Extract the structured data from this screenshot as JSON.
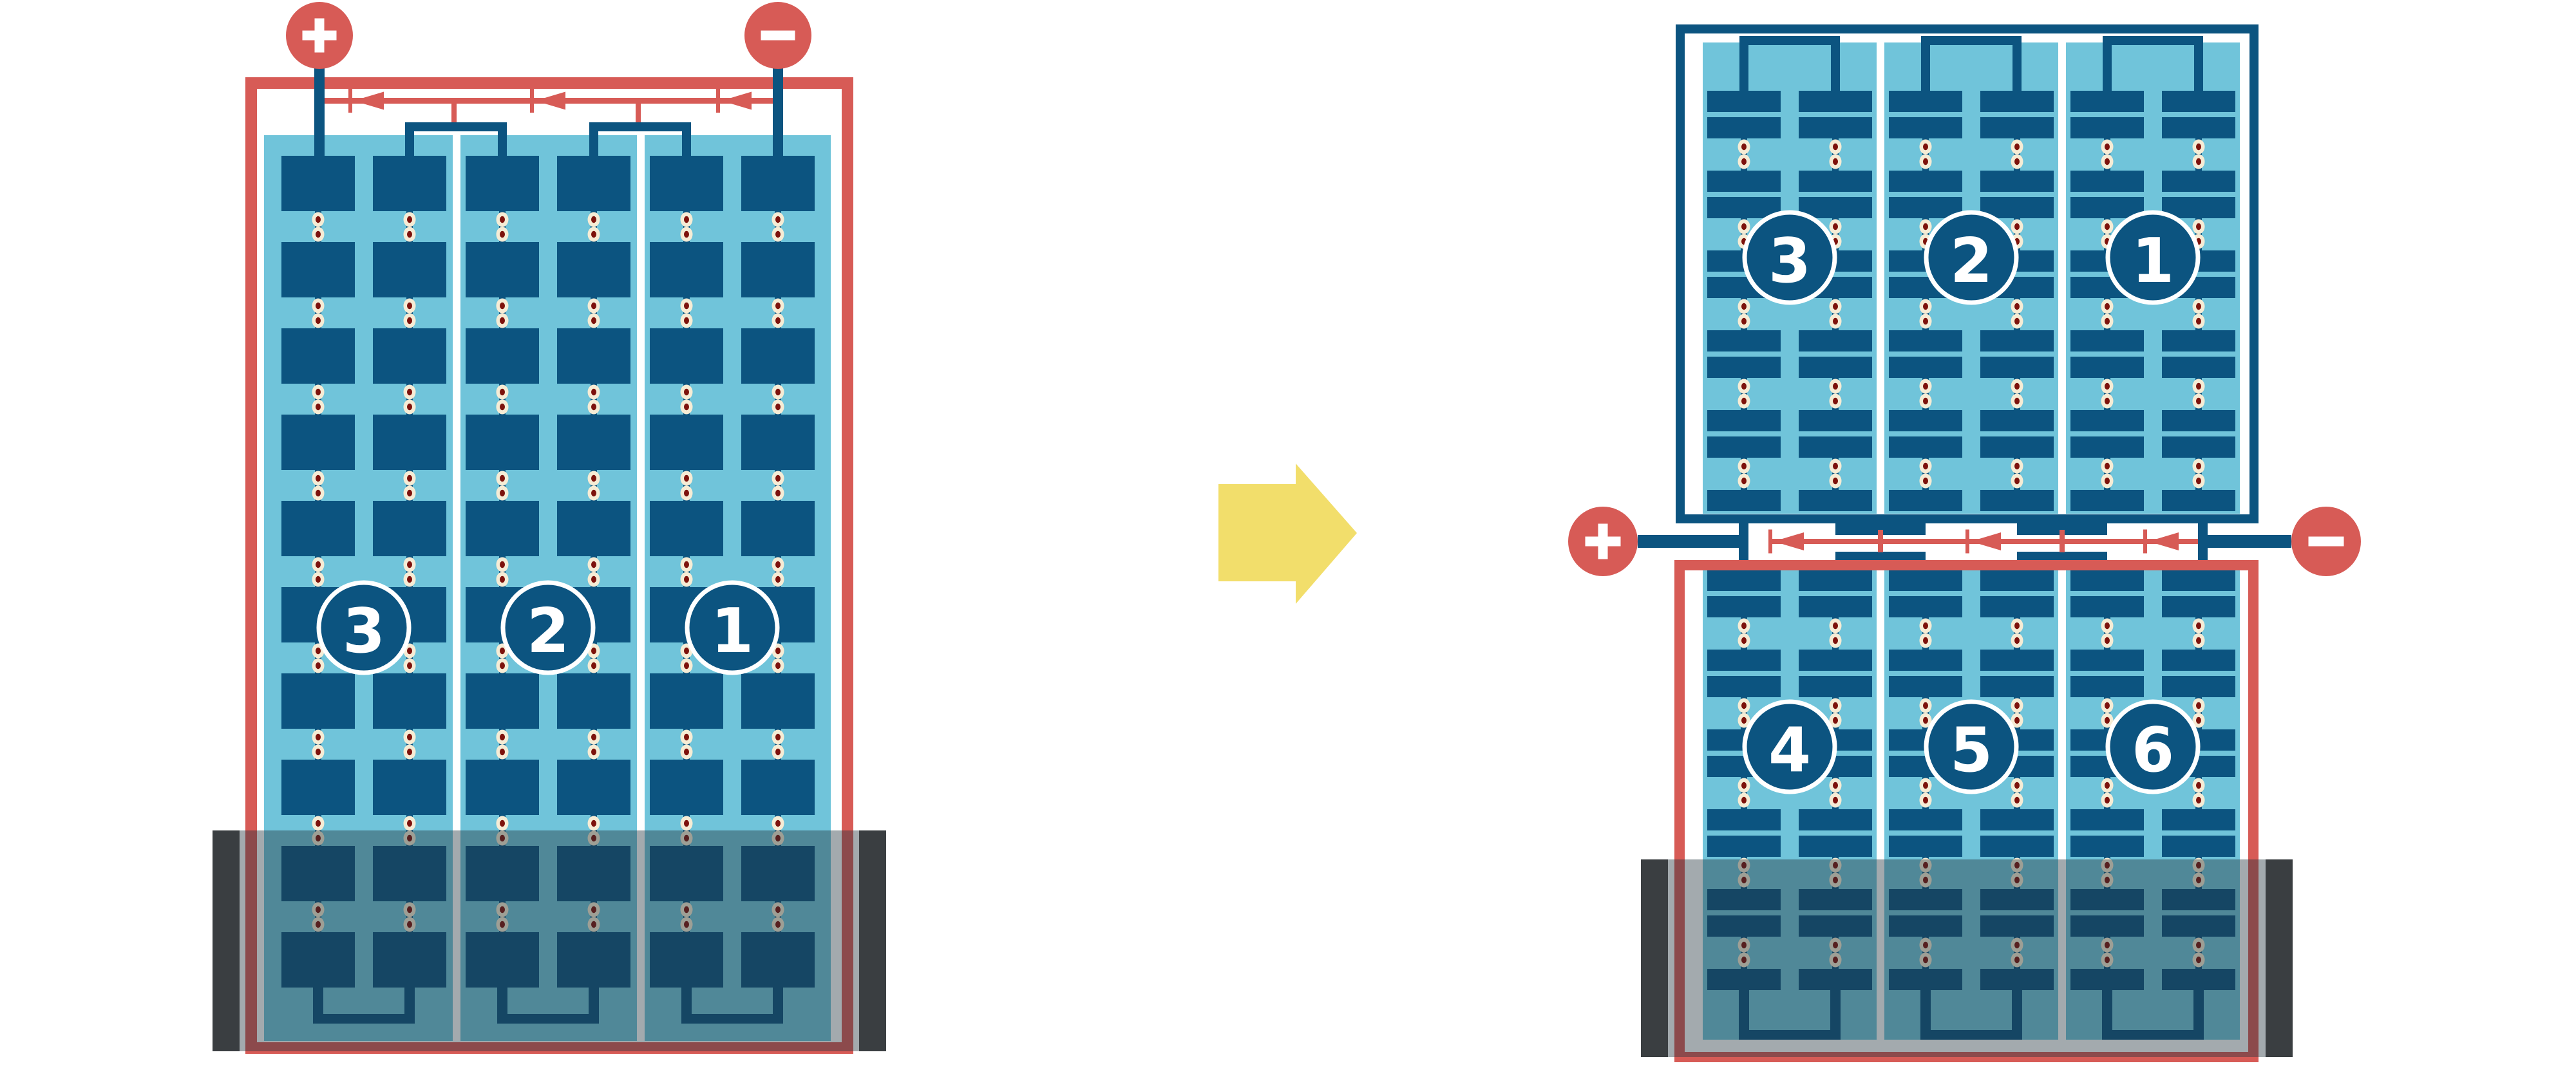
{
  "diagram": {
    "type": "solar-module-wiring-comparison",
    "colors": {
      "red": "#D75B56",
      "dark_blue": "#0C5480",
      "light_blue": "#70C4DA",
      "dot_outer": "#F6ECD5",
      "dot_inner": "#7D120C",
      "shade_overlay": "rgba(35,52,63,0.42)",
      "shade_post": "#3A3E41",
      "arrow_yellow": "#F2DE6B",
      "label_text": "#FFFFFF",
      "background": "#FFFFFF"
    },
    "left_module": {
      "terminals": {
        "positive": {
          "icon": "plus",
          "symbol": "+"
        },
        "negative": {
          "icon": "minus",
          "symbol": "−"
        }
      },
      "bypass_diodes": 3,
      "cell_rows": 10,
      "columns_per_section": 2,
      "sections": [
        {
          "label": "3"
        },
        {
          "label": "2"
        },
        {
          "label": "1"
        }
      ],
      "shaded_bottom": true
    },
    "arrow": {
      "icon": "arrow-right",
      "direction": "right"
    },
    "right_top_module": {
      "half_cell_rows": 11,
      "columns_per_section": 2,
      "sections": [
        {
          "label": "3"
        },
        {
          "label": "2"
        },
        {
          "label": "1"
        }
      ],
      "shaded_bottom": false
    },
    "junction": {
      "terminals": {
        "positive": {
          "icon": "plus",
          "symbol": "+"
        },
        "negative": {
          "icon": "minus",
          "symbol": "−"
        }
      },
      "bypass_diodes": 3
    },
    "right_bottom_module": {
      "half_cell_rows": 11,
      "columns_per_section": 2,
      "sections": [
        {
          "label": "4"
        },
        {
          "label": "5"
        },
        {
          "label": "6"
        }
      ],
      "shaded_bottom": true
    }
  }
}
